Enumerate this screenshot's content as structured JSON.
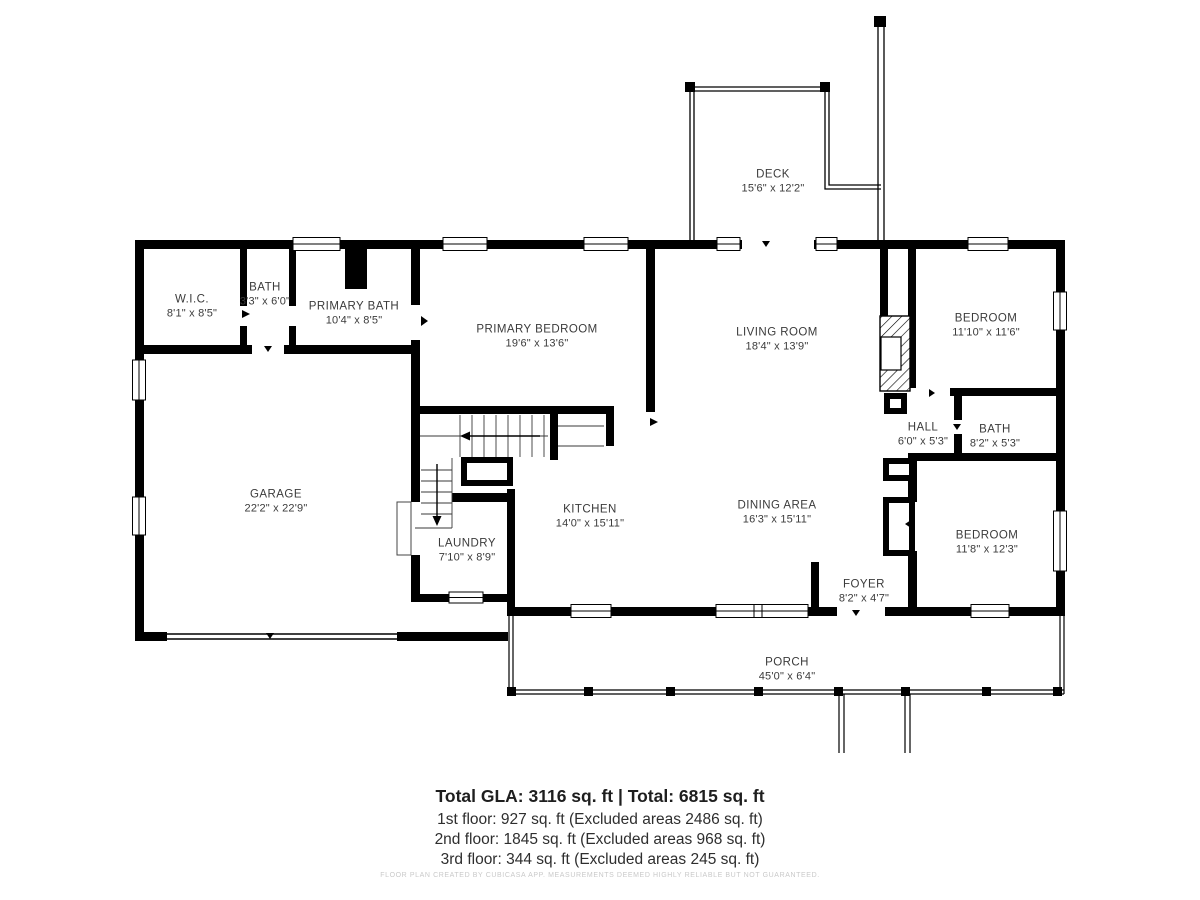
{
  "floorplan": {
    "rooms": {
      "deck": {
        "name": "DECK",
        "dims": "15'6\" x 12'2\""
      },
      "wic": {
        "name": "W.I.C.",
        "dims": "8'1\" x 8'5\""
      },
      "bath_upper": {
        "name": "BATH",
        "dims": "3'3\" x 6'0\""
      },
      "primary_bath": {
        "name": "PRIMARY BATH",
        "dims": "10'4\" x 8'5\""
      },
      "primary_bedroom": {
        "name": "PRIMARY BEDROOM",
        "dims": "19'6\" x 13'6\""
      },
      "living_room": {
        "name": "LIVING ROOM",
        "dims": "18'4\" x 13'9\""
      },
      "bedroom_ne": {
        "name": "BEDROOM",
        "dims": "11'10\" x 11'6\""
      },
      "hall": {
        "name": "HALL",
        "dims": "6'0\" x 5'3\""
      },
      "bath_east": {
        "name": "BATH",
        "dims": "8'2\" x 5'3\""
      },
      "garage": {
        "name": "GARAGE",
        "dims": "22'2\" x 22'9\""
      },
      "laundry": {
        "name": "LAUNDRY",
        "dims": "7'10\" x 8'9\""
      },
      "kitchen": {
        "name": "KITCHEN",
        "dims": "14'0\" x 15'11\""
      },
      "dining_area": {
        "name": "DINING AREA",
        "dims": "16'3\" x 15'11\""
      },
      "foyer": {
        "name": "FOYER",
        "dims": "8'2\" x 4'7\""
      },
      "bedroom_se": {
        "name": "BEDROOM",
        "dims": "11'8\" x 12'3\""
      },
      "porch": {
        "name": "PORCH",
        "dims": "45'0\" x 6'4\""
      }
    },
    "summary": {
      "total": "Total GLA: 3116 sq. ft | Total: 6815 sq. ft",
      "floor1": "1st floor: 927 sq. ft (Excluded areas 2486 sq. ft)",
      "floor2": "2nd floor: 1845 sq. ft (Excluded areas 968 sq. ft)",
      "floor3": "3rd floor: 344 sq. ft (Excluded areas 245 sq. ft)"
    },
    "disclaimer": "FLOOR PLAN CREATED BY CUBICASA APP. MEASUREMENTS DEEMED HIGHLY RELIABLE BUT NOT GUARANTEED.",
    "colors": {
      "wall": "#000000",
      "background": "#ffffff",
      "label_text": "#3b3b3b",
      "disclaimer_text": "#c9c9c9"
    }
  }
}
